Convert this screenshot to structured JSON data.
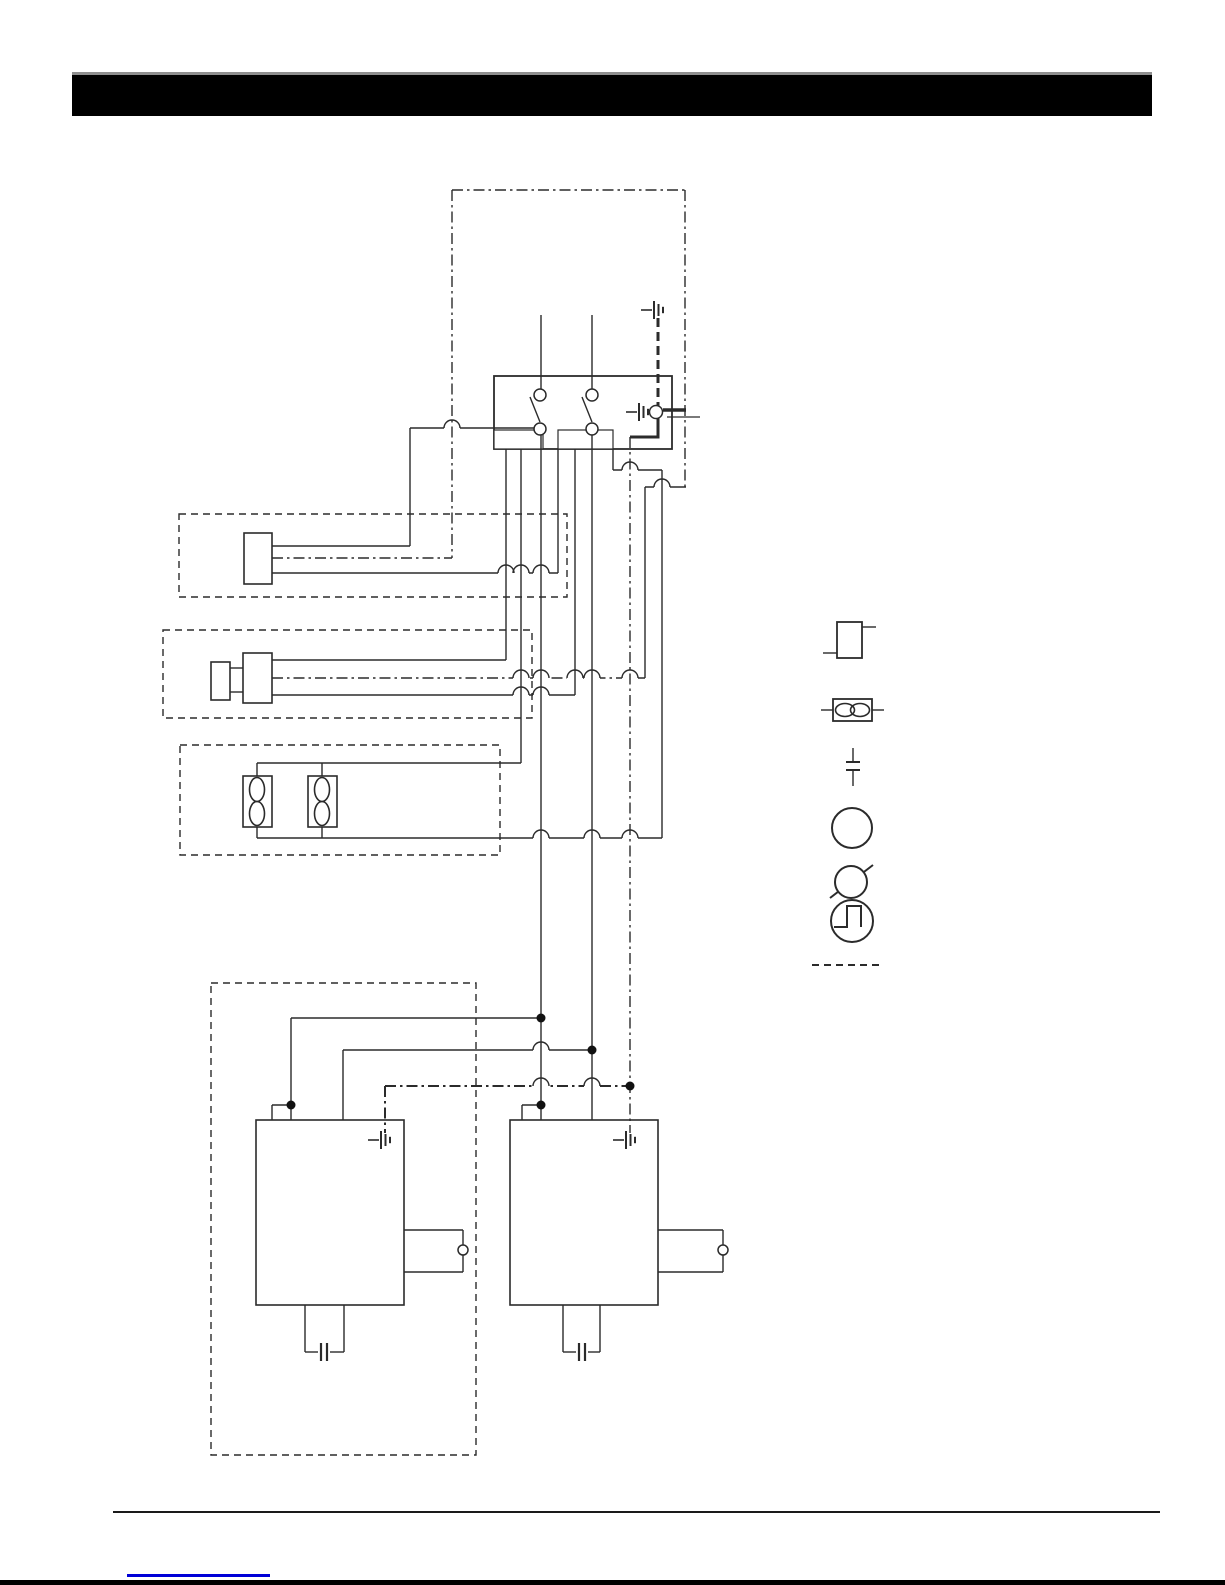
{
  "page": {
    "width": 1225,
    "height": 1585,
    "background": "#ffffff"
  },
  "header": {
    "bar": {
      "x": 72,
      "y": 72,
      "w": 1080,
      "h": 41,
      "color": "#000000",
      "top_edge_color": "#8f8f8f",
      "top_edge_h": 3
    }
  },
  "footer": {
    "rule": {
      "x": 113,
      "y": 1511,
      "w": 1047,
      "h": 2,
      "color": "#1a1a1a"
    },
    "link_underline": {
      "x": 127,
      "y": 1574,
      "w": 143,
      "h": 3,
      "color": "#0000d6"
    },
    "bottom_bar": {
      "y": 1580,
      "h": 5,
      "color": "#000000"
    }
  },
  "diagram": {
    "stroke": "#2b2b2b",
    "legend": {
      "items": [
        {
          "name": "heating-element-symbol"
        },
        {
          "name": "fan-symbol"
        },
        {
          "name": "thermal-fuse-symbol"
        },
        {
          "name": "protective-earth-symbol"
        },
        {
          "name": "crossed-circle-symbol"
        },
        {
          "name": "thermostat-symbol"
        },
        {
          "name": "dashed-line-symbol"
        }
      ]
    },
    "dashed_rects": [
      {
        "name": "module-outline-element",
        "x": 179,
        "y": 514,
        "w": 388,
        "h": 83
      },
      {
        "name": "module-outline-motor",
        "x": 163,
        "y": 630,
        "w": 369,
        "h": 88
      },
      {
        "name": "module-outline-fans",
        "x": 180,
        "y": 745,
        "w": 320,
        "h": 110
      },
      {
        "name": "module-outline-board-assembly",
        "x": 211,
        "y": 983,
        "w": 265,
        "h": 472
      }
    ],
    "rects": [
      {
        "name": "switch-box",
        "x": 494,
        "y": 376,
        "w": 178,
        "h": 73,
        "sw": 1.8
      },
      {
        "name": "terminal-block",
        "x": 494,
        "y": 430,
        "w": 49,
        "h": 19,
        "sw": 1.2
      },
      {
        "name": "terminal-block",
        "x": 558,
        "y": 430,
        "w": 55,
        "h": 19,
        "sw": 1.2
      },
      {
        "name": "component-body",
        "x": 244,
        "y": 533,
        "w": 28,
        "h": 51,
        "sw": 1.6
      },
      {
        "name": "motor-body",
        "x": 211,
        "y": 662,
        "w": 19,
        "h": 38,
        "sw": 1.6
      },
      {
        "name": "motor-body",
        "x": 243,
        "y": 653,
        "w": 29,
        "h": 50,
        "sw": 1.6
      },
      {
        "name": "fan-body",
        "x": 243,
        "y": 776,
        "w": 29,
        "h": 51,
        "sw": 1.6
      },
      {
        "name": "fan-body",
        "x": 308,
        "y": 776,
        "w": 29,
        "h": 51,
        "sw": 1.6
      },
      {
        "name": "control-board",
        "x": 256,
        "y": 1120,
        "w": 148,
        "h": 185,
        "sw": 1.6
      },
      {
        "name": "control-board",
        "x": 510,
        "y": 1120,
        "w": 148,
        "h": 185,
        "sw": 1.6
      },
      {
        "name": "legend-heating-element",
        "x": 837,
        "y": 622,
        "w": 25,
        "h": 36,
        "sw": 1.8
      },
      {
        "name": "legend-fan",
        "x": 833,
        "y": 699,
        "w": 39,
        "h": 22,
        "sw": 1.8
      }
    ],
    "lines": [
      {
        "x1": 541,
        "y1": 315,
        "x2": 541,
        "y2": 389,
        "name": "supply-wire"
      },
      {
        "x1": 592,
        "y1": 315,
        "x2": 592,
        "y2": 389,
        "name": "supply-wire"
      },
      {
        "x1": 452,
        "y1": 190,
        "x2": 685,
        "y2": 190,
        "s": "dashdot",
        "name": "enclosure-earth-line"
      },
      {
        "x1": 685,
        "y1": 190,
        "x2": 685,
        "y2": 487,
        "s": "dashdot",
        "name": "enclosure-earth-line"
      },
      {
        "x1": 658,
        "y1": 318,
        "x2": 658,
        "y2": 406,
        "s": "bolddash",
        "w": 3,
        "name": "earth-bond-wire"
      },
      {
        "x1": 658,
        "y1": 418,
        "x2": 658,
        "y2": 437,
        "w": 3,
        "name": "earth-bond-wire"
      },
      {
        "x1": 630,
        "y1": 437,
        "x2": 659.5,
        "y2": 437,
        "w": 3,
        "name": "earth-bond-wire"
      },
      {
        "x1": 663,
        "y1": 410,
        "x2": 686,
        "y2": 410,
        "w": 3.5,
        "name": "earth-terminal-lead"
      },
      {
        "x1": 667,
        "y1": 417,
        "x2": 700,
        "y2": 417,
        "w": 1.2,
        "name": "earth-terminal-lead"
      },
      {
        "x1": 410,
        "y1": 428,
        "x2": 534,
        "y2": 428,
        "name": "wire"
      },
      {
        "x1": 410,
        "y1": 428,
        "x2": 410,
        "y2": 546,
        "name": "wire"
      },
      {
        "x1": 272,
        "y1": 546,
        "x2": 410,
        "y2": 546,
        "name": "wire"
      },
      {
        "x1": 272,
        "y1": 558,
        "x2": 452,
        "y2": 558,
        "s": "dashdot",
        "name": "earth-wire"
      },
      {
        "x1": 272,
        "y1": 573,
        "x2": 558,
        "y2": 573,
        "name": "wire"
      },
      {
        "x1": 613,
        "y1": 470,
        "x2": 662,
        "y2": 470,
        "name": "wire"
      },
      {
        "x1": 272,
        "y1": 660,
        "x2": 506,
        "y2": 660,
        "name": "wire"
      },
      {
        "x1": 272,
        "y1": 678,
        "x2": 645,
        "y2": 678,
        "s": "dashdot",
        "name": "earth-wire"
      },
      {
        "x1": 272,
        "y1": 695,
        "x2": 575,
        "y2": 695,
        "name": "wire"
      },
      {
        "x1": 230,
        "y1": 668,
        "x2": 243,
        "y2": 668,
        "name": "motor-link"
      },
      {
        "x1": 230,
        "y1": 692,
        "x2": 243,
        "y2": 692,
        "name": "motor-link"
      },
      {
        "x1": 645,
        "y1": 487,
        "x2": 686,
        "y2": 487,
        "name": "wire"
      },
      {
        "x1": 257,
        "y1": 763,
        "x2": 521,
        "y2": 763,
        "name": "fan-bus"
      },
      {
        "x1": 257,
        "y1": 838,
        "x2": 662,
        "y2": 838,
        "name": "fan-bus"
      },
      {
        "x1": 291,
        "y1": 1018,
        "x2": 541,
        "y2": 1018,
        "name": "wire"
      },
      {
        "x1": 343,
        "y1": 1050,
        "x2": 592,
        "y2": 1050,
        "name": "wire"
      },
      {
        "x1": 385,
        "y1": 1086,
        "x2": 630,
        "y2": 1086,
        "s": "dashdot",
        "w": 2,
        "name": "earth-wire"
      },
      {
        "x1": 291,
        "y1": 1105,
        "x2": 272,
        "y2": 1105,
        "name": "board-stub"
      },
      {
        "x1": 272,
        "y1": 1105,
        "x2": 272,
        "y2": 1120,
        "name": "board-stub"
      },
      {
        "x1": 541,
        "y1": 1105,
        "x2": 522,
        "y2": 1105,
        "name": "board-stub"
      },
      {
        "x1": 522,
        "y1": 1105,
        "x2": 522,
        "y2": 1120,
        "name": "board-stub"
      },
      {
        "x1": 404,
        "y1": 1230,
        "x2": 463,
        "y2": 1230,
        "name": "board-tab"
      },
      {
        "x1": 463,
        "y1": 1230,
        "x2": 463,
        "y2": 1272,
        "name": "board-tab"
      },
      {
        "x1": 404,
        "y1": 1272,
        "x2": 463,
        "y2": 1272,
        "name": "board-tab"
      },
      {
        "x1": 658,
        "y1": 1230,
        "x2": 723,
        "y2": 1230,
        "name": "board-tab"
      },
      {
        "x1": 723,
        "y1": 1230,
        "x2": 723,
        "y2": 1272,
        "name": "board-tab"
      },
      {
        "x1": 658,
        "y1": 1272,
        "x2": 723,
        "y2": 1272,
        "name": "board-tab"
      },
      {
        "x1": 305,
        "y1": 1305,
        "x2": 305,
        "y2": 1352,
        "name": "capacitor-lead"
      },
      {
        "x1": 344,
        "y1": 1305,
        "x2": 344,
        "y2": 1352,
        "name": "capacitor-lead"
      },
      {
        "x1": 305,
        "y1": 1352,
        "x2": 318,
        "y2": 1352,
        "name": "capacitor-lead"
      },
      {
        "x1": 330,
        "y1": 1352,
        "x2": 344,
        "y2": 1352,
        "name": "capacitor-lead"
      },
      {
        "x1": 321,
        "y1": 1343,
        "x2": 321,
        "y2": 1361,
        "w": 2.2,
        "name": "capacitor-plate"
      },
      {
        "x1": 327,
        "y1": 1343,
        "x2": 327,
        "y2": 1361,
        "w": 2.2,
        "name": "capacitor-plate"
      },
      {
        "x1": 563,
        "y1": 1305,
        "x2": 563,
        "y2": 1352,
        "name": "capacitor-lead"
      },
      {
        "x1": 600,
        "y1": 1305,
        "x2": 600,
        "y2": 1352,
        "name": "capacitor-lead"
      },
      {
        "x1": 563,
        "y1": 1352,
        "x2": 576,
        "y2": 1352,
        "name": "capacitor-lead"
      },
      {
        "x1": 588,
        "y1": 1352,
        "x2": 600,
        "y2": 1352,
        "name": "capacitor-lead"
      },
      {
        "x1": 579,
        "y1": 1343,
        "x2": 579,
        "y2": 1361,
        "w": 2.2,
        "name": "capacitor-plate"
      },
      {
        "x1": 585,
        "y1": 1343,
        "x2": 585,
        "y2": 1361,
        "w": 2.2,
        "name": "capacitor-plate"
      },
      {
        "x1": 530,
        "y1": 397,
        "x2": 540,
        "y2": 422,
        "name": "switch-blade"
      },
      {
        "x1": 582,
        "y1": 397,
        "x2": 592,
        "y2": 422,
        "name": "switch-blade"
      },
      {
        "x1": 862,
        "y1": 627,
        "x2": 876,
        "y2": 627,
        "name": "legend-lead"
      },
      {
        "x1": 823,
        "y1": 653,
        "x2": 837,
        "y2": 653,
        "name": "legend-lead"
      },
      {
        "x1": 821,
        "y1": 710,
        "x2": 833,
        "y2": 710,
        "name": "legend-lead"
      },
      {
        "x1": 872,
        "y1": 710,
        "x2": 884,
        "y2": 710,
        "name": "legend-lead"
      },
      {
        "x1": 853,
        "y1": 748,
        "x2": 853,
        "y2": 762,
        "name": "thermal-fuse-symbol"
      },
      {
        "x1": 846,
        "y1": 762,
        "x2": 860,
        "y2": 762,
        "w": 2,
        "name": "thermal-fuse-symbol"
      },
      {
        "x1": 846,
        "y1": 770,
        "x2": 860,
        "y2": 770,
        "w": 2,
        "name": "thermal-fuse-symbol"
      },
      {
        "x1": 853,
        "y1": 770,
        "x2": 853,
        "y2": 786,
        "name": "thermal-fuse-symbol"
      },
      {
        "x1": 852,
        "y1": 810,
        "x2": 852,
        "y2": 829,
        "name": "protective-earth-symbol"
      },
      {
        "x1": 838,
        "y1": 829,
        "x2": 866,
        "y2": 829,
        "w": 2,
        "name": "protective-earth-symbol"
      },
      {
        "x1": 843,
        "y1": 836,
        "x2": 861,
        "y2": 836,
        "w": 2,
        "name": "protective-earth-symbol"
      },
      {
        "x1": 848,
        "y1": 843,
        "x2": 856,
        "y2": 843,
        "w": 2,
        "name": "protective-earth-symbol"
      },
      {
        "x1": 830,
        "y1": 898,
        "x2": 873,
        "y2": 865,
        "w": 2,
        "name": "crossed-circle-symbol"
      },
      {
        "x1": 812,
        "y1": 965,
        "x2": 880,
        "y2": 965,
        "s": "dash",
        "w": 2,
        "name": "dashed-line-symbol"
      }
    ],
    "over_lines": [
      {
        "x1": 452,
        "y1": 190,
        "x2": 452,
        "y2": 558,
        "s": "dashdot",
        "name": "enclosure-earth-line"
      },
      {
        "x1": 506,
        "y1": 449,
        "x2": 506,
        "y2": 660,
        "name": "wire"
      },
      {
        "x1": 521,
        "y1": 449,
        "x2": 521,
        "y2": 763,
        "name": "wire"
      },
      {
        "x1": 558,
        "y1": 449,
        "x2": 558,
        "y2": 573,
        "name": "wire"
      },
      {
        "x1": 575,
        "y1": 449,
        "x2": 575,
        "y2": 695,
        "name": "wire"
      },
      {
        "x1": 613,
        "y1": 449,
        "x2": 613,
        "y2": 470,
        "name": "wire"
      },
      {
        "x1": 541,
        "y1": 435,
        "x2": 541,
        "y2": 1120,
        "name": "line-wire"
      },
      {
        "x1": 592,
        "y1": 435,
        "x2": 592,
        "y2": 1120,
        "name": "line-wire"
      },
      {
        "x1": 630,
        "y1": 437,
        "x2": 630,
        "y2": 1133,
        "s": "dashdot",
        "name": "earth-wire"
      },
      {
        "x1": 662,
        "y1": 470,
        "x2": 662,
        "y2": 838,
        "name": "wire"
      },
      {
        "x1": 645,
        "y1": 487,
        "x2": 645,
        "y2": 678,
        "name": "earth-riser"
      },
      {
        "x1": 291,
        "y1": 1018,
        "x2": 291,
        "y2": 1120,
        "name": "wire"
      },
      {
        "x1": 343,
        "y1": 1050,
        "x2": 343,
        "y2": 1120,
        "name": "wire"
      },
      {
        "x1": 385,
        "y1": 1086,
        "x2": 385,
        "y2": 1133,
        "s": "dashdot",
        "w": 2,
        "name": "earth-wire"
      },
      {
        "x1": 257,
        "y1": 763,
        "x2": 257,
        "y2": 776,
        "name": "fan-stub"
      },
      {
        "x1": 322,
        "y1": 763,
        "x2": 322,
        "y2": 776,
        "name": "fan-stub"
      },
      {
        "x1": 257,
        "y1": 827,
        "x2": 257,
        "y2": 838,
        "name": "fan-stub"
      },
      {
        "x1": 322,
        "y1": 827,
        "x2": 322,
        "y2": 838,
        "name": "fan-stub"
      }
    ],
    "hops": [
      {
        "x": 452,
        "y": 428
      },
      {
        "x": 506,
        "y": 573
      },
      {
        "x": 521,
        "y": 573
      },
      {
        "x": 541,
        "y": 573
      },
      {
        "x": 521,
        "y": 678
      },
      {
        "x": 541,
        "y": 678
      },
      {
        "x": 575,
        "y": 678
      },
      {
        "x": 592,
        "y": 678
      },
      {
        "x": 630,
        "y": 678
      },
      {
        "x": 521,
        "y": 695
      },
      {
        "x": 541,
        "y": 695
      },
      {
        "x": 630,
        "y": 470
      },
      {
        "x": 662,
        "y": 487
      },
      {
        "x": 541,
        "y": 838
      },
      {
        "x": 592,
        "y": 838
      },
      {
        "x": 630,
        "y": 838
      },
      {
        "x": 541,
        "y": 1050
      },
      {
        "x": 541,
        "y": 1086
      },
      {
        "x": 592,
        "y": 1086
      }
    ],
    "dots": [
      {
        "x": 541,
        "y": 1018
      },
      {
        "x": 592,
        "y": 1050
      },
      {
        "x": 630,
        "y": 1086
      },
      {
        "x": 291,
        "y": 1105
      },
      {
        "x": 541,
        "y": 1105
      }
    ],
    "open_circles": [
      {
        "x": 540,
        "y": 395,
        "r": 6,
        "name": "switch-contact"
      },
      {
        "x": 592,
        "y": 395,
        "r": 6,
        "name": "switch-contact"
      },
      {
        "x": 540,
        "y": 429,
        "r": 6,
        "name": "switch-contact"
      },
      {
        "x": 592,
        "y": 429,
        "r": 6,
        "name": "switch-contact"
      },
      {
        "x": 656,
        "y": 412,
        "r": 6.5,
        "name": "earth-terminal"
      },
      {
        "x": 463,
        "y": 1250,
        "r": 5,
        "name": "board-terminal"
      },
      {
        "x": 723,
        "y": 1250,
        "r": 5,
        "name": "board-terminal"
      },
      {
        "x": 852,
        "y": 828,
        "r": 20,
        "name": "protective-earth-symbol"
      },
      {
        "x": 851,
        "y": 882,
        "r": 16,
        "name": "crossed-circle-symbol"
      },
      {
        "x": 852,
        "y": 921,
        "r": 21,
        "name": "thermostat-symbol"
      }
    ],
    "grounds": [
      {
        "x": 654,
        "y": 310,
        "name": "chassis-ground-icon"
      },
      {
        "x": 639,
        "y": 412,
        "name": "chassis-ground-icon"
      },
      {
        "x": 381,
        "y": 1140,
        "name": "chassis-ground-icon"
      },
      {
        "x": 626,
        "y": 1140,
        "name": "chassis-ground-icon"
      }
    ],
    "ellipses": [
      {
        "cx": 257,
        "cy": 789.5,
        "rx": 7.5,
        "ry": 12,
        "name": "fan-blade-icon"
      },
      {
        "cx": 257,
        "cy": 813.5,
        "rx": 7.5,
        "ry": 12,
        "name": "fan-blade-icon"
      },
      {
        "cx": 322,
        "cy": 789.5,
        "rx": 7.5,
        "ry": 12,
        "name": "fan-blade-icon"
      },
      {
        "cx": 322,
        "cy": 813.5,
        "rx": 7.5,
        "ry": 12,
        "name": "fan-blade-icon"
      },
      {
        "cx": 845,
        "cy": 710,
        "rx": 9.5,
        "ry": 6.5,
        "name": "fan-symbol"
      },
      {
        "cx": 860,
        "cy": 710,
        "rx": 9.5,
        "ry": 6.5,
        "name": "fan-symbol"
      }
    ],
    "paths": [
      {
        "d": "M 834 927 L 847 927 L 847 906 L 861 906 L 861 927",
        "w": 2,
        "name": "thermostat-symbol"
      }
    ]
  }
}
